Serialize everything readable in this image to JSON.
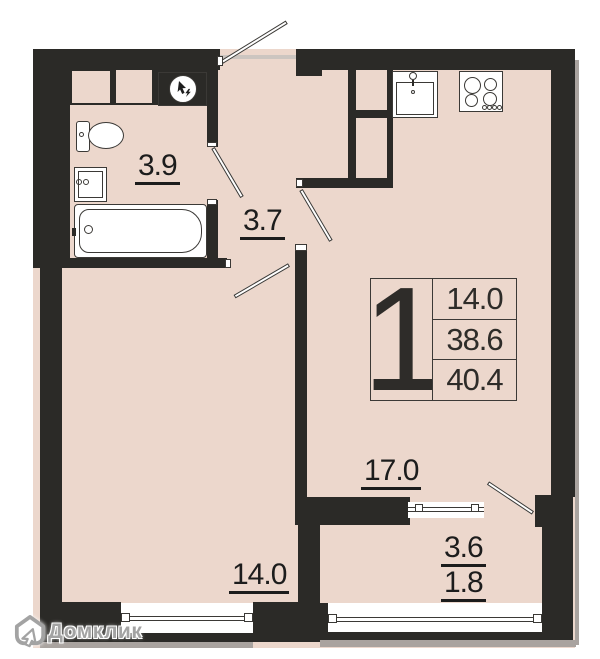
{
  "plan_type": "apartment-floor-plan",
  "info_box": {
    "rooms_count": "1",
    "values": [
      "14.0",
      "38.6",
      "40.4"
    ]
  },
  "room_labels": {
    "bathroom": "3.9",
    "hallway": "3.7",
    "kitchen_living": "17.0",
    "bedroom": "14.0",
    "balcony_a": "3.6",
    "balcony_b": "1.8"
  },
  "watermark": {
    "brand": "Домклик"
  },
  "icons": [
    "electric-panel-icon",
    "toilet-icon",
    "washbasin-icon",
    "bathtub-icon",
    "kitchen-sink-icon",
    "stove-icon",
    "domclick-house-icon"
  ],
  "colors": {
    "floor": "#ecd7cc",
    "wall": "#2b2a27",
    "line": "#3b3936",
    "label": "#1c1c1c",
    "watermark": "#a3a3a3",
    "shadow": "#a9a39f"
  }
}
